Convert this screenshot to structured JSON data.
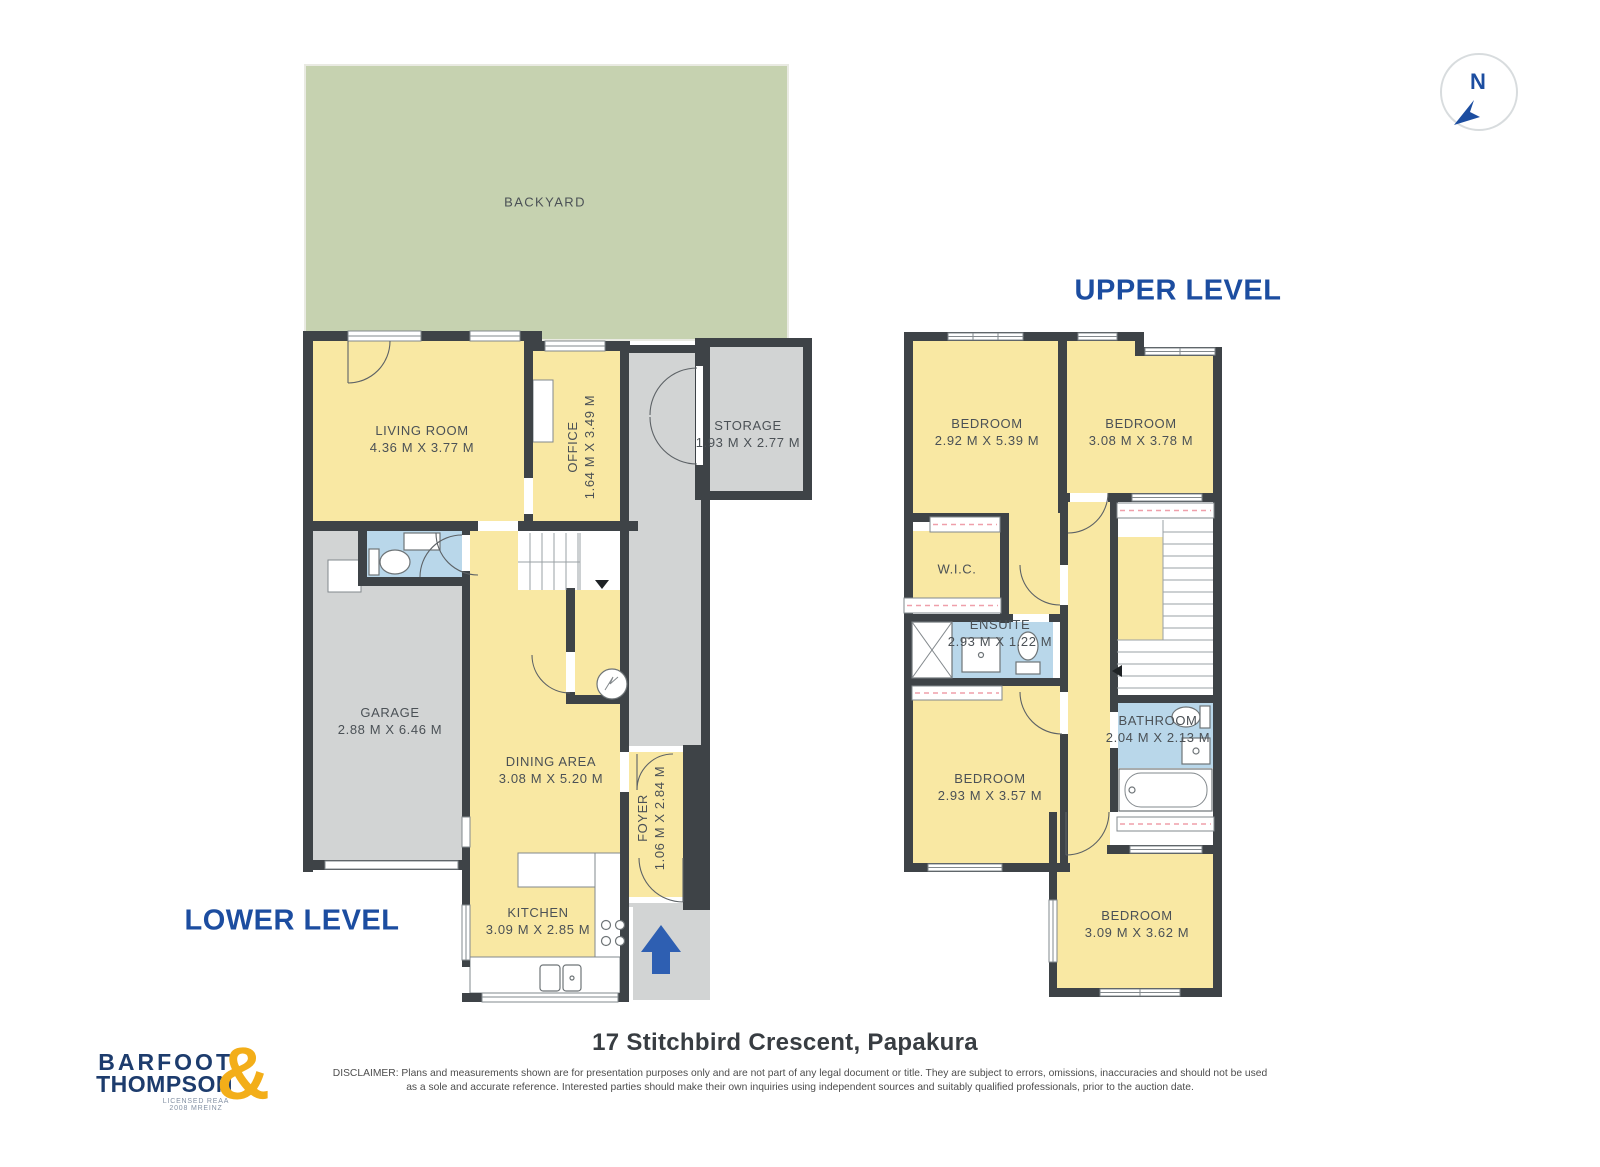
{
  "compass": {
    "label": "N"
  },
  "levels": {
    "lower": {
      "title": "LOWER LEVEL",
      "rooms": {
        "backyard": {
          "name": "BACKYARD"
        },
        "living_room": {
          "name": "LIVING ROOM",
          "dims": "4.36 M X 3.77 M"
        },
        "office": {
          "name": "OFFICE",
          "dims": "1.64 M X 3.49 M"
        },
        "storage": {
          "name": "STORAGE",
          "dims": "1.93 M X 2.77 M"
        },
        "garage": {
          "name": "GARAGE",
          "dims": "2.88 M X 6.46 M"
        },
        "dining_area": {
          "name": "DINING AREA",
          "dims": "3.08 M X 5.20 M"
        },
        "foyer": {
          "name": "FOYER",
          "dims": "1.06 M X 2.84 M"
        },
        "kitchen": {
          "name": "KITCHEN",
          "dims": "3.09 M X 2.85 M"
        }
      }
    },
    "upper": {
      "title": "UPPER LEVEL",
      "rooms": {
        "bedroom_1": {
          "name": "BEDROOM",
          "dims": "2.92 M X 5.39 M"
        },
        "bedroom_2": {
          "name": "BEDROOM",
          "dims": "3.08 M X 3.78 M"
        },
        "wic": {
          "name": "W.I.C."
        },
        "ensuite": {
          "name": "ENSUITE",
          "dims": "2.93 M X 1.22 M"
        },
        "bathroom": {
          "name": "BATHROOM",
          "dims": "2.04 M X 2.13 M"
        },
        "bedroom_3": {
          "name": "BEDROOM",
          "dims": "2.93 M X 3.57 M"
        },
        "bedroom_4": {
          "name": "BEDROOM",
          "dims": "3.09 M X 3.62 M"
        }
      }
    }
  },
  "footer": {
    "address": "17 Stitchbird Crescent, Papakura",
    "disclaimer_line1": "DISCLAIMER: Plans and measurements shown are for presentation purposes only and are not part of any legal document or title. They are subject to errors, omissions, inaccuracies and should not be used",
    "disclaimer_line2": "as a sole and accurate reference. Interested parties should make their own inquiries using independent sources and suitably qualified professionals, prior to the auction date.",
    "logo": {
      "line1": "BARFOOT",
      "line2": "THOMPSON",
      "ampersand": "&",
      "tagline": "LICENSED REAA 2008 MREINZ"
    }
  },
  "colors": {
    "wall": "#3E4347",
    "room_yellow": "#F9E8A3",
    "area_gray": "#D2D4D4",
    "backyard_green": "#C6D2B0",
    "wet_blue": "#B9D7EA",
    "accent_blue": "#1C4DA0",
    "arrow_blue": "#2E5FB2",
    "logo_navy": "#1D3C6D",
    "logo_gold": "#F3AE19",
    "label_text": "#4B5156",
    "wardrobe_pink": "#EF9FAA"
  }
}
